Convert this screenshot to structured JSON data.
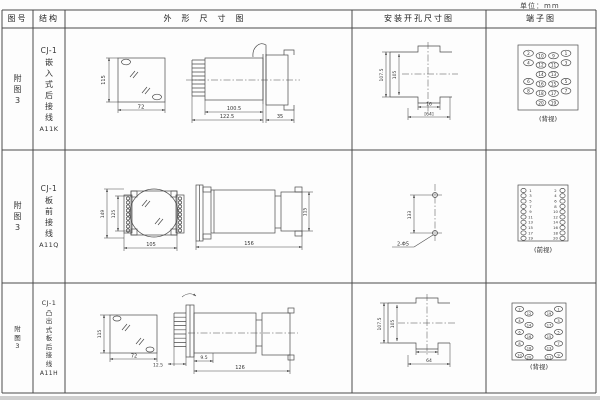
{
  "page": {
    "unit": "单位：mm"
  },
  "headers": {
    "fig": "图号",
    "structure": "结构",
    "outline": "外形尺寸图",
    "install": "安装开孔尺寸图",
    "terminal": "端子图"
  },
  "rows": [
    {
      "fig": "附图3",
      "structure": {
        "model": "CJ-1",
        "type": "嵌入式后接线",
        "code": "A11K"
      },
      "outline": {
        "front_h": "115",
        "front_w": "72",
        "body_len": "100.5",
        "total_len": "122.5",
        "rear_len": "35"
      },
      "install": {
        "outer_h": "107.5",
        "inner_h": "105",
        "notch_w": "16",
        "total_w": "[64]"
      },
      "terminal": {
        "view": "(背视)",
        "grid": [
          [
            "2",
            "10",
            "9",
            "1"
          ],
          [
            "4",
            "12",
            "11",
            "3"
          ],
          [
            "",
            "14",
            "13",
            ""
          ],
          [
            "6",
            "16",
            "15",
            "5"
          ],
          [
            "8",
            "18",
            "17",
            "7"
          ],
          [
            "",
            "20",
            "19",
            ""
          ]
        ]
      }
    },
    {
      "fig": "附图3",
      "structure": {
        "model": "CJ-1",
        "type": "板前接线",
        "code": "A11Q"
      },
      "outline": {
        "front_h_outer": "149",
        "front_h_inner": "125",
        "front_w": "105",
        "side_len": "156",
        "side_h": "115"
      },
      "install": {
        "hole_pitch": "133",
        "hole_label": "2-Φ5"
      },
      "terminal": {
        "view": "(前视)",
        "pairs": [
          [
            "1",
            "2"
          ],
          [
            "3",
            "4"
          ],
          [
            "5",
            "6"
          ],
          [
            "7",
            "8"
          ],
          [
            "9",
            "10"
          ],
          [
            "11",
            "12"
          ],
          [
            "13",
            "14"
          ],
          [
            "15",
            "16"
          ],
          [
            "17",
            "18"
          ],
          [
            "19",
            "20"
          ]
        ]
      }
    },
    {
      "fig": "附图3",
      "structure": {
        "model": "CJ-1",
        "type": "凸出式板后接线",
        "code": "A11H"
      },
      "outline": {
        "front_h": "115",
        "front_w": "72",
        "pin_len": "12.5",
        "flange_d": "9.5",
        "total_len": "126"
      },
      "install": {
        "outer_h": "107.5",
        "inner_h": "105",
        "total_w": "64"
      },
      "terminal": {
        "view": "(背视)",
        "left_outer": [
          "2",
          "4",
          "6",
          "8",
          "10"
        ],
        "left_inner": [
          "12",
          "14",
          "16",
          "18",
          "20"
        ],
        "right_inner": [
          "19",
          "17",
          "15",
          "13",
          "11"
        ],
        "right_outer": [
          "1",
          "3",
          "5",
          "7",
          "9"
        ]
      }
    }
  ]
}
